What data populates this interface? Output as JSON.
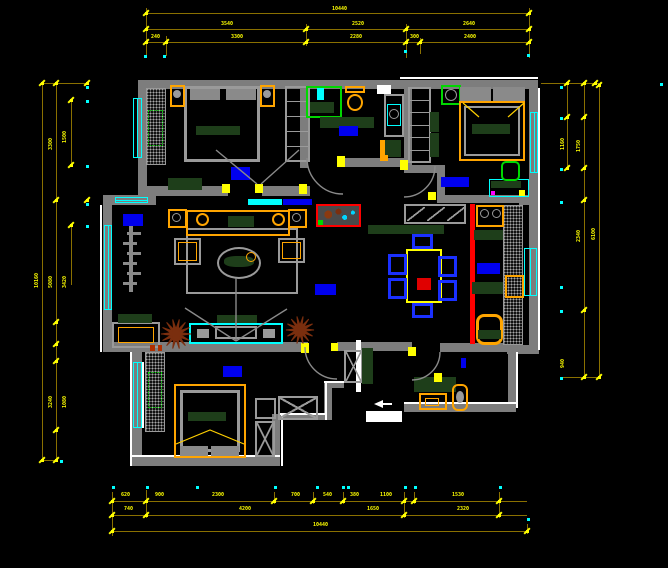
{
  "title": "CAD apartment floor plan viewport",
  "colors": {
    "background": "#000000",
    "wall": "#7d7d7d",
    "wall_outline": "#ffffff",
    "dimension_line": "#8a7000",
    "dimension_mark": "#ffff00",
    "dimension_text": "#ffff00",
    "window": "#00ffff",
    "furniture_frame": "#ffa500",
    "upholstery_green": "#1e3e1a",
    "fixture_green": "#00d800",
    "label_highlight": "#0000ee",
    "chair_blue": "#1a30ff",
    "highlight_wall_red": "#ff0000",
    "plant_brown": "#7a2e0e",
    "accent_magenta": "#ff00ff",
    "table_red": "#e00000"
  },
  "dimensions": {
    "top": {
      "texts": [
        {
          "x": 332,
          "y": 7,
          "t": "10440"
        },
        {
          "x": 221,
          "y": 22,
          "t": "3540"
        },
        {
          "x": 352,
          "y": 22,
          "t": "2520"
        },
        {
          "x": 463,
          "y": 22,
          "t": "2640"
        },
        {
          "x": 151,
          "y": 35,
          "t": "240"
        },
        {
          "x": 231,
          "y": 35,
          "t": "3300"
        },
        {
          "x": 350,
          "y": 35,
          "t": "2280"
        },
        {
          "x": 410,
          "y": 35,
          "t": "300"
        },
        {
          "x": 464,
          "y": 35,
          "t": "2400"
        }
      ]
    },
    "bottom": {
      "texts": [
        {
          "x": 121,
          "y": 493,
          "t": "620"
        },
        {
          "x": 155,
          "y": 493,
          "t": "900"
        },
        {
          "x": 212,
          "y": 493,
          "t": "2300"
        },
        {
          "x": 291,
          "y": 493,
          "t": "700"
        },
        {
          "x": 323,
          "y": 493,
          "t": "540"
        },
        {
          "x": 350,
          "y": 493,
          "t": "380"
        },
        {
          "x": 380,
          "y": 493,
          "t": "1100"
        },
        {
          "x": 452,
          "y": 493,
          "t": "1530"
        },
        {
          "x": 124,
          "y": 507,
          "t": "740"
        },
        {
          "x": 239,
          "y": 507,
          "t": "4200"
        },
        {
          "x": 367,
          "y": 507,
          "t": "1650"
        },
        {
          "x": 457,
          "y": 507,
          "t": "2320"
        },
        {
          "x": 313,
          "y": 523,
          "t": "10440"
        }
      ]
    },
    "left": {
      "texts": [
        {
          "x": 35,
          "y": 288,
          "t": "10160",
          "r": 1
        },
        {
          "x": 49,
          "y": 288,
          "t": "5080",
          "r": 1
        },
        {
          "x": 63,
          "y": 288,
          "t": "3420",
          "r": 1
        },
        {
          "x": 49,
          "y": 150,
          "t": "3300",
          "r": 1
        },
        {
          "x": 63,
          "y": 143,
          "t": "1500",
          "r": 1
        },
        {
          "x": 49,
          "y": 408,
          "t": "3240",
          "r": 1
        },
        {
          "x": 63,
          "y": 408,
          "t": "1080",
          "r": 1
        }
      ]
    },
    "right": {
      "texts": [
        {
          "x": 561,
          "y": 150,
          "t": "1160",
          "r": 1
        },
        {
          "x": 561,
          "y": 368,
          "t": "940",
          "r": 1
        },
        {
          "x": 577,
          "y": 152,
          "t": "1750",
          "r": 1
        },
        {
          "x": 577,
          "y": 242,
          "t": "2340",
          "r": 1
        },
        {
          "x": 592,
          "y": 240,
          "t": "6100",
          "r": 1
        }
      ]
    }
  },
  "rooms": {
    "label_highlights": [
      {
        "name": "bedroom-1-label"
      },
      {
        "name": "bathroom-label"
      },
      {
        "name": "bedroom-2-label"
      },
      {
        "name": "living-room-label"
      },
      {
        "name": "corridor-label"
      },
      {
        "name": "bedroom-3-label"
      },
      {
        "name": "kitchen-label"
      },
      {
        "name": "entry-label"
      },
      {
        "name": "partition-label"
      }
    ]
  }
}
